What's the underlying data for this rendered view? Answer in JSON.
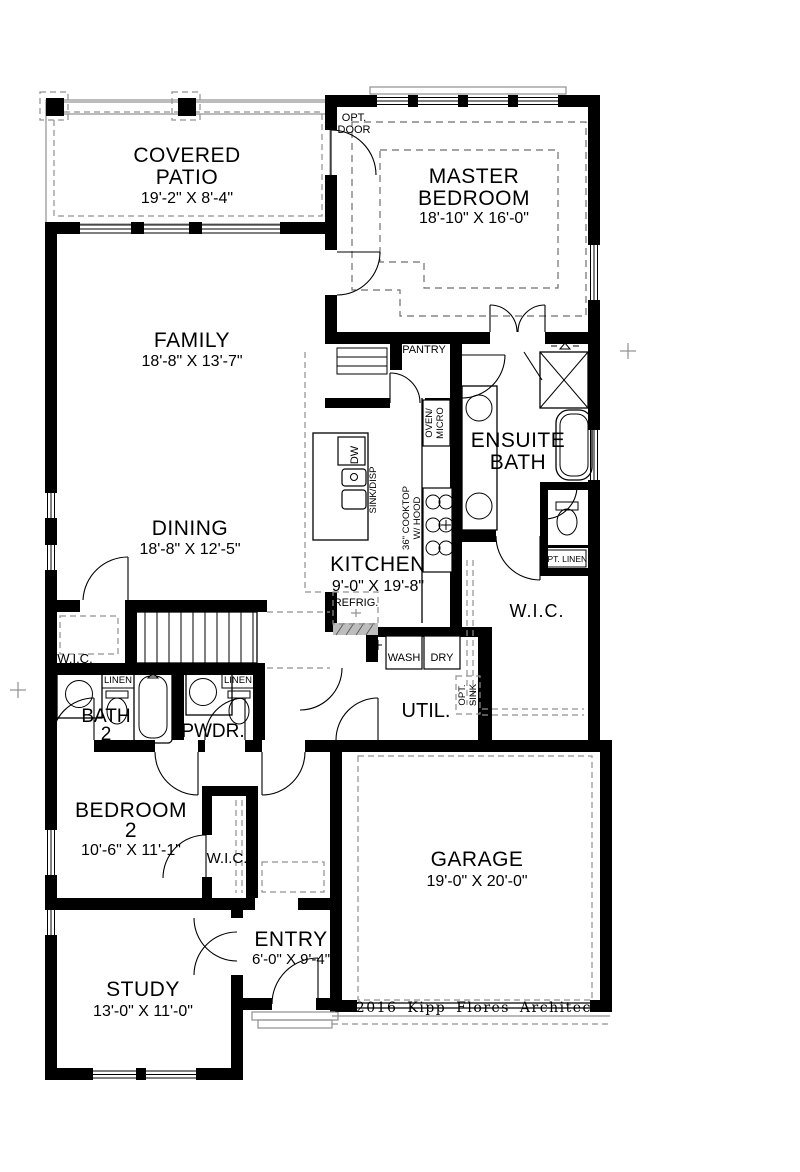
{
  "plan": {
    "copyright": "© 2016 Kipp Flores Architects"
  },
  "colors": {
    "wall": "#000000",
    "dashed_gray": "#909090",
    "background": "#ffffff",
    "text": "#000000"
  },
  "rooms": {
    "covered_patio": {
      "line1": "COVERED",
      "line2": "PATIO",
      "dims": "19'-2\" X 8'-4\""
    },
    "master_bedroom": {
      "line1": "MASTER",
      "line2": "BEDROOM",
      "dims": "18'-10\" X 16'-0\""
    },
    "family": {
      "name": "FAMILY",
      "dims": "18'-8\" X 13'-7\""
    },
    "dining": {
      "name": "DINING",
      "dims": "18'-8\" X 12'-5\""
    },
    "kitchen": {
      "name": "KITCHEN",
      "dims": "9'-0\" X 19'-8\""
    },
    "ensuite_bath": {
      "line1": "ENSUITE",
      "line2": "BATH"
    },
    "master_wic": {
      "name": "W.I.C."
    },
    "hall_wic": {
      "name": "W.I.C."
    },
    "bath2": {
      "line1": "BATH",
      "line2": "2"
    },
    "powder": {
      "name": "PWDR."
    },
    "utility": {
      "name": "UTIL."
    },
    "bedroom2": {
      "line1": "BEDROOM",
      "line2": "2",
      "dims": "10'-6\" X 11'-1\""
    },
    "bedroom2_wic": {
      "name": "W.I.C."
    },
    "garage": {
      "name": "GARAGE",
      "dims": "19'-0\" X 20'-0\""
    },
    "entry": {
      "name": "ENTRY",
      "dims": "6'-0\" X 9'-4\""
    },
    "study": {
      "name": "STUDY",
      "dims": "13'-0\" X 11'-0\""
    }
  },
  "fixtures": {
    "opt_door": {
      "line1": "OPT.",
      "line2": "DOOR"
    },
    "pantry": "PANTRY",
    "oven_micro": {
      "line1": "OVEN/",
      "line2": "MICRO"
    },
    "dw": "DW",
    "sink_disp": "SINK/DISP",
    "cooktop": {
      "line1": "36\" COOKTOP",
      "line2": "W/ HOOD"
    },
    "refrig": "REFRIG.",
    "wash": "WASH",
    "dry": "DRY",
    "opt_sink": {
      "line1": "OPT.",
      "line2": "SINK"
    },
    "opt_linen": "OPT. LINEN",
    "linen": "LINEN"
  }
}
